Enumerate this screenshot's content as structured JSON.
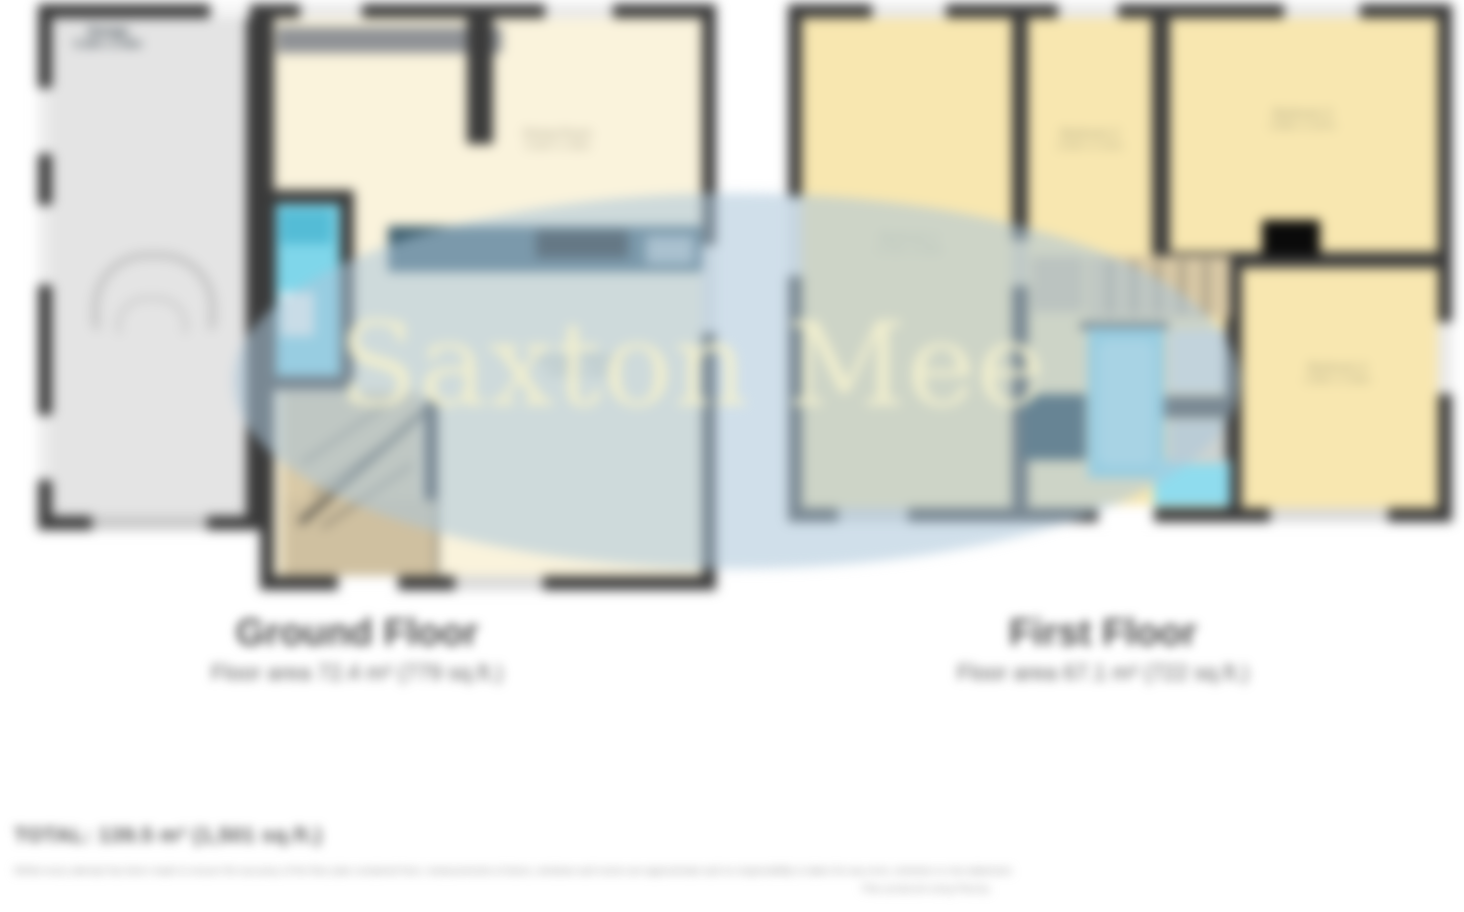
{
  "watermark": {
    "text": "Saxton Mee"
  },
  "ground_floor": {
    "title": "Ground Floor",
    "area": "Floor area 72.4 m² (779 sq.ft.)",
    "garage": {
      "name": "Garage",
      "dims": "5.18m x 2.46m"
    },
    "front_room": {
      "name": "Dining Room",
      "dims": "3.33m x 2.95m"
    },
    "main_room": {
      "name": "Lounge / Kitchen",
      "dims": "6.93m x 4.55m"
    }
  },
  "first_floor": {
    "title": "First Floor",
    "area": "Floor area 67.1 m² (722 sq.ft.)",
    "bedroom1": {
      "name": "Bedroom 1",
      "dims": "3.73m x 3.35m"
    },
    "bedroom2": {
      "name": "Bedroom 2",
      "dims": "2.62m x 2.31m"
    },
    "bedroom3": {
      "name": "Bedroom 3",
      "dims": "3.96m x 2.87m"
    },
    "bedroom4": {
      "name": "Bedroom 4",
      "dims": "2.90m x 2.69m"
    }
  },
  "footer": {
    "total": "TOTAL: 139.5 m² (1,501 sq.ft.)",
    "disclaimer": "Whilst every attempt has been made to ensure the accuracy of the floor plan contained here, measurements of doors, windows and rooms are approximate and no responsibility is taken for any error, omission or mis-statement.",
    "produced": "Plan produced using PlanUp."
  },
  "colors": {
    "wall_dark": "#3a3a3a",
    "room_cream": "#faf3dc",
    "bedroom_yellow": "#f8e7b0",
    "garage_grey": "#e4e4e4",
    "bath_cyan": "#7fd6ea",
    "counter_teal": "#3f6070",
    "stairs_tan": "#d9c9a6",
    "watermark_blue": "#aec6db"
  }
}
